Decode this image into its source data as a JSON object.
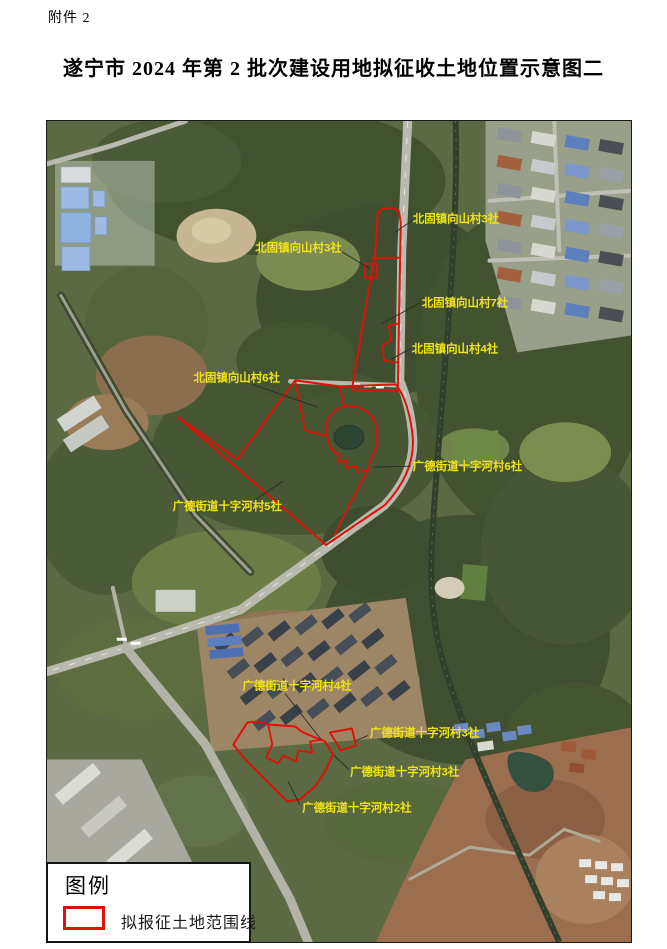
{
  "document": {
    "attachment_label": "附件 2",
    "title": "遂宁市 2024 年第 2 批次建设用地拟征收土地位置示意图二"
  },
  "map": {
    "type": "satellite-parcel-map",
    "boundary_color": "#e11009",
    "label_color": "#f0e317",
    "area_labels": [
      {
        "text": "北固镇向山村3社"
      },
      {
        "text": "北固镇向山村3社"
      },
      {
        "text": "北固镇向山村7社"
      },
      {
        "text": "北固镇向山村4社"
      },
      {
        "text": "北固镇向山村6社"
      },
      {
        "text": "广德街道十字河村6社"
      },
      {
        "text": "广德街道十字河村5社"
      },
      {
        "text": "广德街道十字河村4社"
      },
      {
        "text": "广德街道十字河村3社"
      },
      {
        "text": "广德街道十字河村3社"
      },
      {
        "text": "广德街道十字河村2社"
      }
    ]
  },
  "legend": {
    "title": "图例",
    "item_label": "拟报征土地范围线"
  }
}
